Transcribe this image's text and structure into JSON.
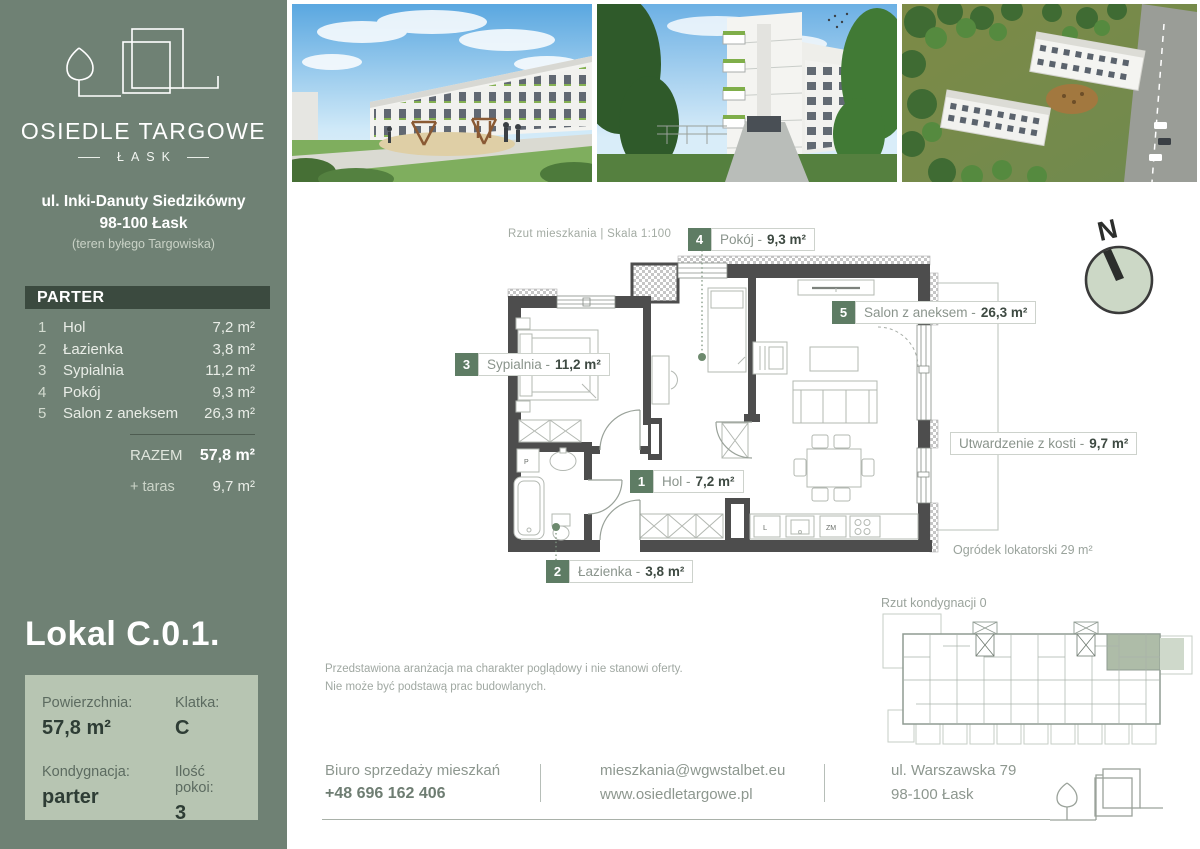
{
  "colors": {
    "sidebar": "#6f8174",
    "header_bar": "#3b4a3f",
    "panel": "#b7c5b2",
    "badge_green": "#5e7c64",
    "dot_green": "#6d8a6e",
    "wall_gray": "#4d4d4d"
  },
  "sidebar": {
    "brand_name": "OSIEDLE TARGOWE",
    "brand_city": "ŁASK",
    "address1": "ul. Inki-Danuty Siedzikówny",
    "address2": "98-100 Łask",
    "address3": "(teren byłego Targowiska)",
    "floor_header": "PARTER",
    "rooms": [
      {
        "no": "1",
        "name": "Hol",
        "area": "7,2 m²"
      },
      {
        "no": "2",
        "name": "Łazienka",
        "area": "3,8 m²"
      },
      {
        "no": "3",
        "name": "Sypialnia",
        "area": "11,2 m²"
      },
      {
        "no": "4",
        "name": "Pokój",
        "area": "9,3 m²"
      },
      {
        "no": "5",
        "name": "Salon z aneksem",
        "area": "26,3 m²"
      }
    ],
    "total_label": "RAZEM",
    "total_value": "57,8 m²",
    "extra_label": "+ taras",
    "extra_value": "9,7 m²",
    "unit_title": "Lokal C.0.1.",
    "info": {
      "area_label": "Powierzchnia:",
      "area_value": "57,8 m²",
      "stair_label": "Klatka:",
      "stair_value": "C",
      "floor_label": "Kondygnacja:",
      "floor_value": "parter",
      "rooms_label": "Ilość pokoi:",
      "rooms_value": "3"
    }
  },
  "plan": {
    "caption": "Rzut mieszkania  |  Skala 1:100",
    "compass_letter": "N",
    "labels": [
      {
        "no": "1",
        "name": "Hol -",
        "area": "7,2 m²"
      },
      {
        "no": "2",
        "name": "Łazienka -",
        "area": "3,8 m²"
      },
      {
        "no": "3",
        "name": "Sypialnia -",
        "area": "11,2 m²"
      },
      {
        "no": "4",
        "name": "Pokój -",
        "area": "9,3 m²"
      },
      {
        "no": "5",
        "name": "Salon z aneksem -",
        "area": "26,3 m²"
      }
    ],
    "terrace": {
      "text": "Utwardzenie z kosti -",
      "area": "9,7 m²"
    },
    "garden_note": "Ogródek lokatorski 29 m²",
    "kitchen": {
      "fridge": "L",
      "dishwasher": "ZM"
    },
    "bathroom": {
      "washer": "P"
    }
  },
  "overview": {
    "caption": "Rzut kondygnacji 0"
  },
  "disclaimer": {
    "line1": "Przedstawiona aranżacja ma charakter poglądowy i nie stanowi oferty.",
    "line2": "Nie może być podstawą prac budowlanych."
  },
  "footer": {
    "office_label": "Biuro sprzedaży mieszkań",
    "phone": "+48 696 162 406",
    "email": "mieszkania@wgwstalbet.eu",
    "website": "www.osiedletargowe.pl",
    "address1": "ul. Warszawska 79",
    "address2": "98-100 Łask"
  }
}
